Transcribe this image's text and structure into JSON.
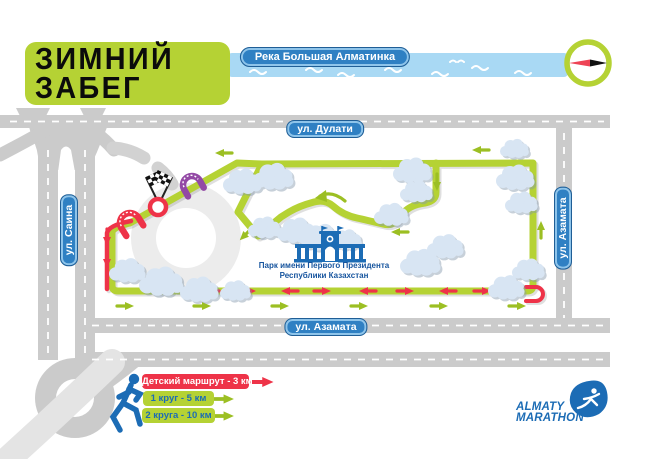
{
  "title": {
    "line1": "ЗИМНИЙ",
    "line2": "ЗАБЕГ"
  },
  "river": {
    "label": "Река Большая Алматинка"
  },
  "roads": {
    "top": "ул. Дулати",
    "left": "ул. Саина",
    "right": "ул. Азамата",
    "bottom": "ул. Азамата"
  },
  "park": {
    "name_line1": "Парк имени Первого Президента",
    "name_line2": "Республики Казахстан"
  },
  "legend": {
    "items": [
      {
        "label": "Детский маршрут - 3 км",
        "color": "#ee3348",
        "text_color": "#ffffff"
      },
      {
        "label": "1 круг - 5 км",
        "color": "#b5d234",
        "text_color": "#1c6cb5"
      },
      {
        "label": "2 круга - 10 км",
        "color": "#b5d234",
        "text_color": "#1c6cb5"
      }
    ]
  },
  "logo": {
    "line1": "ALMATY",
    "line2": "MARATHON"
  },
  "colors": {
    "route_green": "#b5d234",
    "kids_red": "#ee3348",
    "gate_purple": "#9349a5",
    "road_gray": "#cbcbcb",
    "river_blue": "#a9d9f4",
    "badge_blue": "#2f80c3",
    "brand_blue": "#1c6cb5",
    "cloud_blue": "#d8e5f3"
  }
}
